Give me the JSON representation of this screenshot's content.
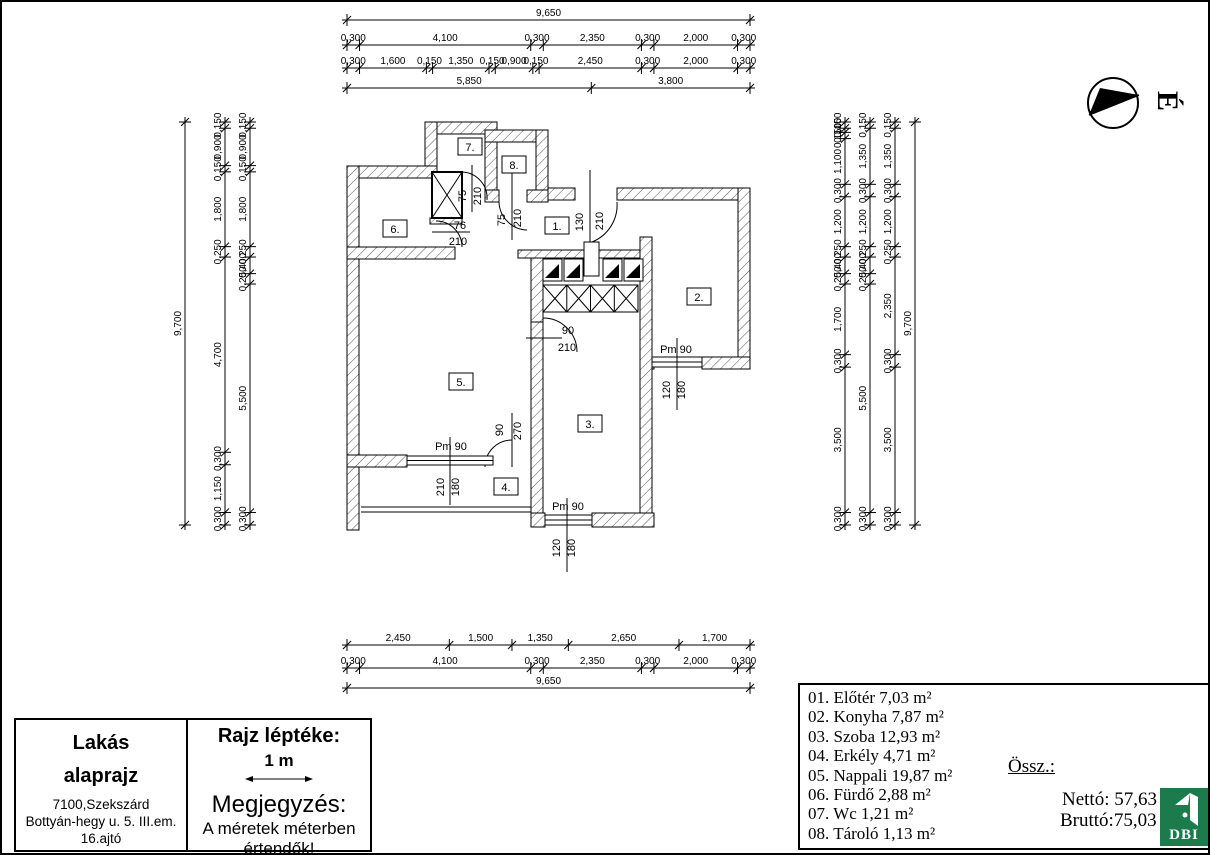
{
  "page": {
    "north": "É"
  },
  "dimensions": {
    "top": {
      "overall": [
        "9,650"
      ],
      "row2": [
        "0,300",
        "4,100",
        "0,300",
        "2,350",
        "0,300",
        "2,000",
        "0,300"
      ],
      "row3": [
        "0,300",
        "1,600",
        "0,150",
        "1,350",
        "0,150",
        "0,900",
        "0,150",
        "2,450",
        "0,300",
        "2,000",
        "0,300"
      ],
      "row4": [
        "5,850",
        "3,800"
      ]
    },
    "bottom": {
      "row1": [
        "2,450",
        "1,500",
        "1,350",
        "2,650",
        "1,700"
      ],
      "row2": [
        "0,300",
        "4,100",
        "0,300",
        "2,350",
        "0,300",
        "2,000",
        "0,300"
      ],
      "overall": [
        "9,650"
      ]
    },
    "left": {
      "overall": [
        "9,700"
      ],
      "col2": [
        "0,150",
        "0,900",
        "0,150",
        "1,800",
        "0,250",
        "4,700",
        "0,300",
        "1,150",
        "0,300"
      ],
      "col3": [
        "0,150",
        "0,900",
        "0,150",
        "1,800",
        "0,250",
        "0,400",
        "0,250",
        "5,500",
        "0,300"
      ]
    },
    "right": {
      "colA": [
        "0,150",
        "0,100",
        "0,150",
        "1,100",
        "0,300",
        "1,200",
        "0,250",
        "0,400",
        "0,250",
        "1,700",
        "0,300",
        "3,500",
        "0,300"
      ],
      "colB": [
        "0,150",
        "1,350",
        "0,300",
        "1,200",
        "0,250",
        "0,400",
        "0,250",
        "5,500",
        "0,300"
      ],
      "colC": [
        "0,150",
        "1,350",
        "0,300",
        "1,200",
        "0,250",
        "2,350",
        "0,300",
        "3,500",
        "0,300"
      ],
      "overall": [
        "9,700"
      ]
    }
  },
  "plan": {
    "rooms": [
      "1.",
      "2.",
      "3.",
      "4.",
      "5.",
      "6.",
      "7.",
      "8."
    ],
    "doors": {
      "wc": {
        "w": "75",
        "h": "210"
      },
      "bath": {
        "w": "76",
        "h": "210"
      },
      "storage": {
        "w": "75",
        "h": "210"
      },
      "entry": {
        "w": "130",
        "h": "210"
      },
      "room3": {
        "w": "90",
        "h": "210"
      },
      "balcony": {
        "w": "90",
        "h": "270"
      }
    },
    "windows": {
      "living": {
        "sill": "Pm 90",
        "w": "210",
        "h": "180"
      },
      "room3": {
        "sill": "Pm 90",
        "w": "120",
        "h": "180"
      },
      "kitchen": {
        "sill": "Pm 90",
        "w": "120",
        "h": "180"
      }
    }
  },
  "legend": {
    "items": [
      "01. Előtér 7,03 m²",
      "02. Konyha 7,87 m²",
      "03. Szoba 12,93 m²",
      "04. Erkély 4,71 m²",
      "05. Nappali 19,87 m²",
      "06. Fürdő 2,88 m²",
      "07. Wc 1,21 m²",
      "08. Tároló 1,13 m²"
    ],
    "total_label": "Össz.:",
    "netto": "Nettó: 57,63",
    "brutto": "Bruttó:75,03"
  },
  "title_block": {
    "title_line1": "Lakás",
    "title_line2": "alaprajz",
    "address1": "7100,Szekszárd",
    "address2": "Bottyán-hegy u. 5. III.em.",
    "address3": "16.ajtó",
    "scale_label": "Rajz léptéke:",
    "scale_value": "1 m",
    "note_title": "Megjegyzés:",
    "note_line1": "A méretek méterben",
    "note_line2": "értendők!"
  },
  "logo": {
    "text": "DBI",
    "color": "#1b7b4b"
  }
}
